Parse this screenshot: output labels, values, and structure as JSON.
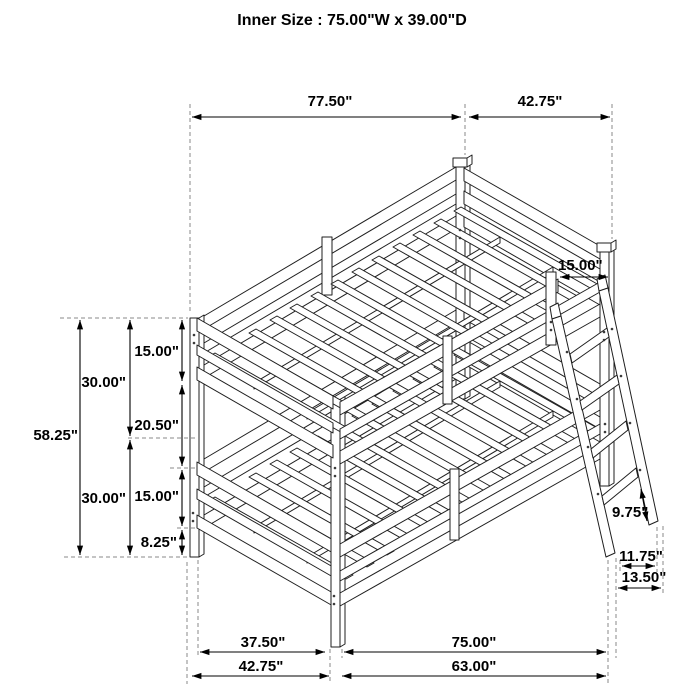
{
  "title": "Inner Size : 75.00\"W x 39.00\"D",
  "diagram": {
    "subject": "twin-over-twin bunk bed with angled ladder, dimension drawing",
    "style": {
      "background": "#ffffff",
      "line_color": "#1f1f1f",
      "dimension_color": "#000000",
      "extension_line_color": "#8a8a8a"
    },
    "dimensions": {
      "top_length": "77.50\"",
      "top_depth": "42.75\"",
      "ladder_opening": "15.00\"",
      "total_height": "58.25\"",
      "upper_section_height": "30.00\"",
      "lower_section_height": "30.00\"",
      "upper_rail_depth": "15.00\"",
      "bunk_gap_height": "20.50\"",
      "lower_rail_depth": "15.00\"",
      "floor_clearance": "8.25\"",
      "ladder_rung_spacing": "9.75\"",
      "ladder_foot_inner": "11.75\"",
      "ladder_foot_outer": "13.50\"",
      "floor_foot_inner": "37.50\"",
      "floor_side_inner": "75.00\"",
      "floor_foot_total": "42.75\"",
      "floor_side_span": "63.00\""
    }
  }
}
